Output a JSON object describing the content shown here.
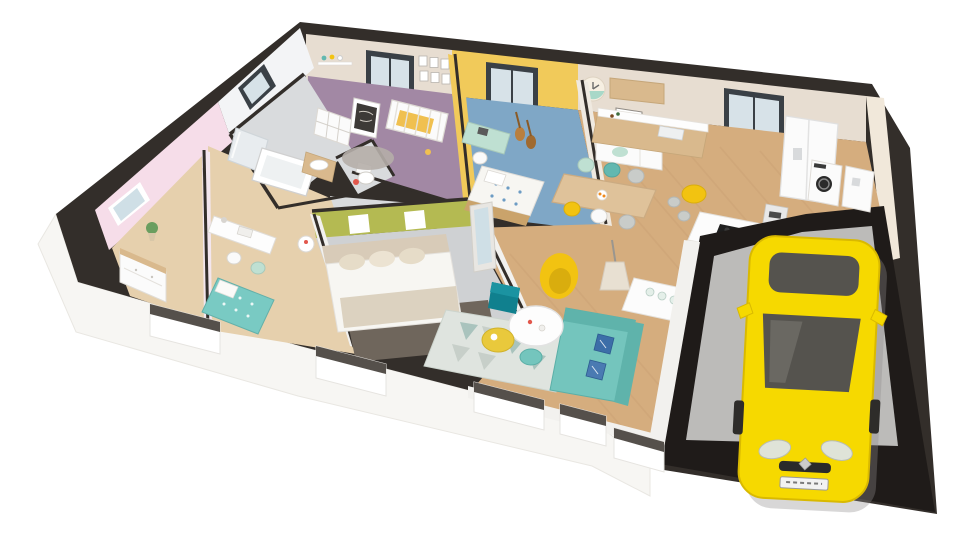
{
  "meta": {
    "type": "3d-floorplan-cutaway-render",
    "background": "#ffffff"
  },
  "palette": {
    "background": "#ffffff",
    "wall_top": "#332e2a",
    "garage_wall": "#1f1b19",
    "wall_exterior": "#f7f6f3",
    "wall_interior_white": "#f2f1ee",
    "wall_beige": "#e7ddd1",
    "wall_yellow": "#f1ca5a",
    "wall_pink": "#f6dde9",
    "wall_tile": "#f3f4f6",
    "wall_cream": "#f1e8da",
    "wall_green": "#b4ba52",
    "floor_beige": "#e6d0ad",
    "floor_purple": "#a288a4",
    "floor_blue": "#7fa7c6",
    "floor_grey": "#d9dbdd",
    "floor_master": "#cfd1d3",
    "floor_wood": "#d5ad7e",
    "plank_line": "#c79e73",
    "floor_garage": "#bcbbb9",
    "window_frame": "#3a4046",
    "glass": "#d7e2e8",
    "furniture_white": "#fbfbfb",
    "wood_furniture": "#d9b98d",
    "wood_dark": "#caa36b",
    "table_top_wood": "#dfc29a",
    "sofa_teal": "#74c5bd",
    "sofa_teal_dark": "#5fb3ab",
    "pouf_teal": "#10808e",
    "accent_yellow": "#f2c311",
    "table_yellow": "#e9c93c",
    "mint": "#bfe0d2",
    "teal_chair": "#63b8b0",
    "grey_chair": "#c9ccc9",
    "rug_living": "#dfe4df",
    "rug_triangle": "#a9c3bd",
    "rug_triangle2": "#c7cfc9",
    "rug_master": "#6f665c",
    "rug_nursery": "#b5aea8",
    "bed_teal": "#79cac3",
    "bed_blue_dot": "#6d9cc4",
    "bed_linen": "#f7f6f2",
    "headboard": "#d8cbb8",
    "throw": "#dcd2c0",
    "crib_blanket": "#f0c050",
    "chalkboard": "#3d3a37",
    "mirror_glass": "#cfdfe6",
    "car_yellow": "#f6d900",
    "car_glass": "#55534e",
    "car_glass_light": "#6a6862",
    "car_grille": "#2a2a2a",
    "cooktop": "#1f1f1f",
    "guitar": "#b97f3e",
    "plant_green": "#6a9e5f",
    "shadow": "#8e8d8b",
    "sill_shade": "#55504b",
    "appliance_door": "#2b2b2b"
  },
  "scene": {
    "view": "isometric-cutaway-top",
    "rooms": [
      {
        "id": "bedroom-left",
        "wall_color_key": "wall_pink",
        "floor_color_key": "floor_beige"
      },
      {
        "id": "bedroom-desk",
        "wall_color_key": "wall_pink",
        "floor_color_key": "floor_beige"
      },
      {
        "id": "bathroom",
        "wall_color_key": "wall_tile",
        "floor_color_key": "floor_grey"
      },
      {
        "id": "wc",
        "wall_color_key": "wall_tile",
        "floor_color_key": "floor_grey"
      },
      {
        "id": "nursery",
        "wall_color_key": "wall_beige",
        "floor_color_key": "floor_purple"
      },
      {
        "id": "teen-bedroom",
        "wall_color_key": "wall_yellow",
        "floor_color_key": "floor_blue"
      },
      {
        "id": "master-bedroom",
        "wall_color_key": "wall_green",
        "floor_color_key": "floor_master"
      },
      {
        "id": "hallway",
        "wall_color_key": "wall_interior_white",
        "floor_color_key": "floor_grey"
      },
      {
        "id": "kitchen-dining-living",
        "wall_color_key": "wall_beige",
        "floor_color_key": "floor_wood"
      },
      {
        "id": "laundry",
        "wall_color_key": "wall_cream",
        "floor_color_key": "floor_wood"
      },
      {
        "id": "garage",
        "wall_color_key": "garage_wall",
        "floor_color_key": "floor_garage"
      }
    ],
    "car": {
      "body_color_key": "car_yellow",
      "logo": "diamond",
      "orientation": "front-facing-bottom"
    }
  }
}
